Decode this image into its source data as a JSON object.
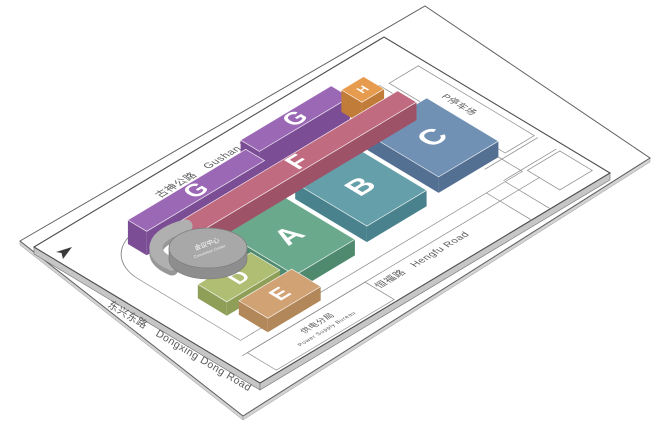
{
  "map": {
    "title": "isometric-site-plan",
    "roads": {
      "gushan": {
        "zh": "古神公路",
        "en": "Gushan Road"
      },
      "dongxing": {
        "zh": "东兴东路",
        "en": "Dongxing Dong Road"
      },
      "hengfu": {
        "zh": "恒福路",
        "en": "Hengfu Road"
      },
      "parking": {
        "label": "P停车场"
      }
    },
    "parcels": {
      "bureau": {
        "zh": "供电分局",
        "en": "Power Supply Bureau"
      }
    },
    "center": {
      "zh": "会议中心",
      "en": "Convention Center"
    },
    "colors": {
      "outline": "#4d4d4d",
      "ground_edge": "#d2d2d2",
      "platform_edge": "#c6c6c6",
      "walkway": "#b0b0b0",
      "cylinder_top": "#a8a8a8",
      "cylinder_side": "#8e8e8e"
    },
    "buildings": [
      {
        "id": "C",
        "label": "C",
        "u1": 290,
        "v1": 100,
        "u2": 360,
        "v2": 184,
        "h": 16,
        "fs": 30,
        "top": "#7191b4",
        "side": "#536f92"
      },
      {
        "id": "B",
        "label": "B",
        "u1": 200,
        "v1": 106,
        "u2": 270,
        "v2": 190,
        "h": 16,
        "fs": 30,
        "top": "#65a0aa",
        "side": "#49828c"
      },
      {
        "id": "A",
        "label": "A",
        "u1": 110,
        "v1": 112,
        "u2": 180,
        "v2": 196,
        "h": 16,
        "fs": 30,
        "top": "#6ba98c",
        "side": "#4f8a6f"
      },
      {
        "id": "G2",
        "label": "G",
        "u1": 202,
        "v1": 40,
        "u2": 308,
        "v2": 62,
        "h": 24,
        "fs": 24,
        "top": "#9b68b6",
        "side": "#7b4d94"
      },
      {
        "id": "H",
        "label": "H",
        "u1": 312,
        "v1": 48,
        "u2": 338,
        "v2": 72,
        "h": 22,
        "fs": 12,
        "top": "#e69b4e",
        "side": "#c07c38"
      },
      {
        "id": "G1",
        "label": "G",
        "u1": 58,
        "v1": 52,
        "u2": 196,
        "v2": 74,
        "h": 24,
        "fs": 24,
        "top": "#9b68b6",
        "side": "#7b4d94"
      },
      {
        "id": "F",
        "label": "F",
        "u1": 92,
        "v1": 78,
        "u2": 348,
        "v2": 100,
        "h": 18,
        "fs": 26,
        "top": "#c16b81",
        "side": "#9d5268"
      },
      {
        "id": "D",
        "label": "D",
        "u1": 46,
        "v1": 146,
        "u2": 108,
        "v2": 180,
        "h": 14,
        "fs": 22,
        "top": "#afbe73",
        "side": "#8f9f58"
      },
      {
        "id": "E",
        "label": "E",
        "u1": 54,
        "v1": 186,
        "u2": 116,
        "v2": 220,
        "h": 14,
        "fs": 22,
        "top": "#d1a274",
        "side": "#b2875a"
      }
    ]
  }
}
